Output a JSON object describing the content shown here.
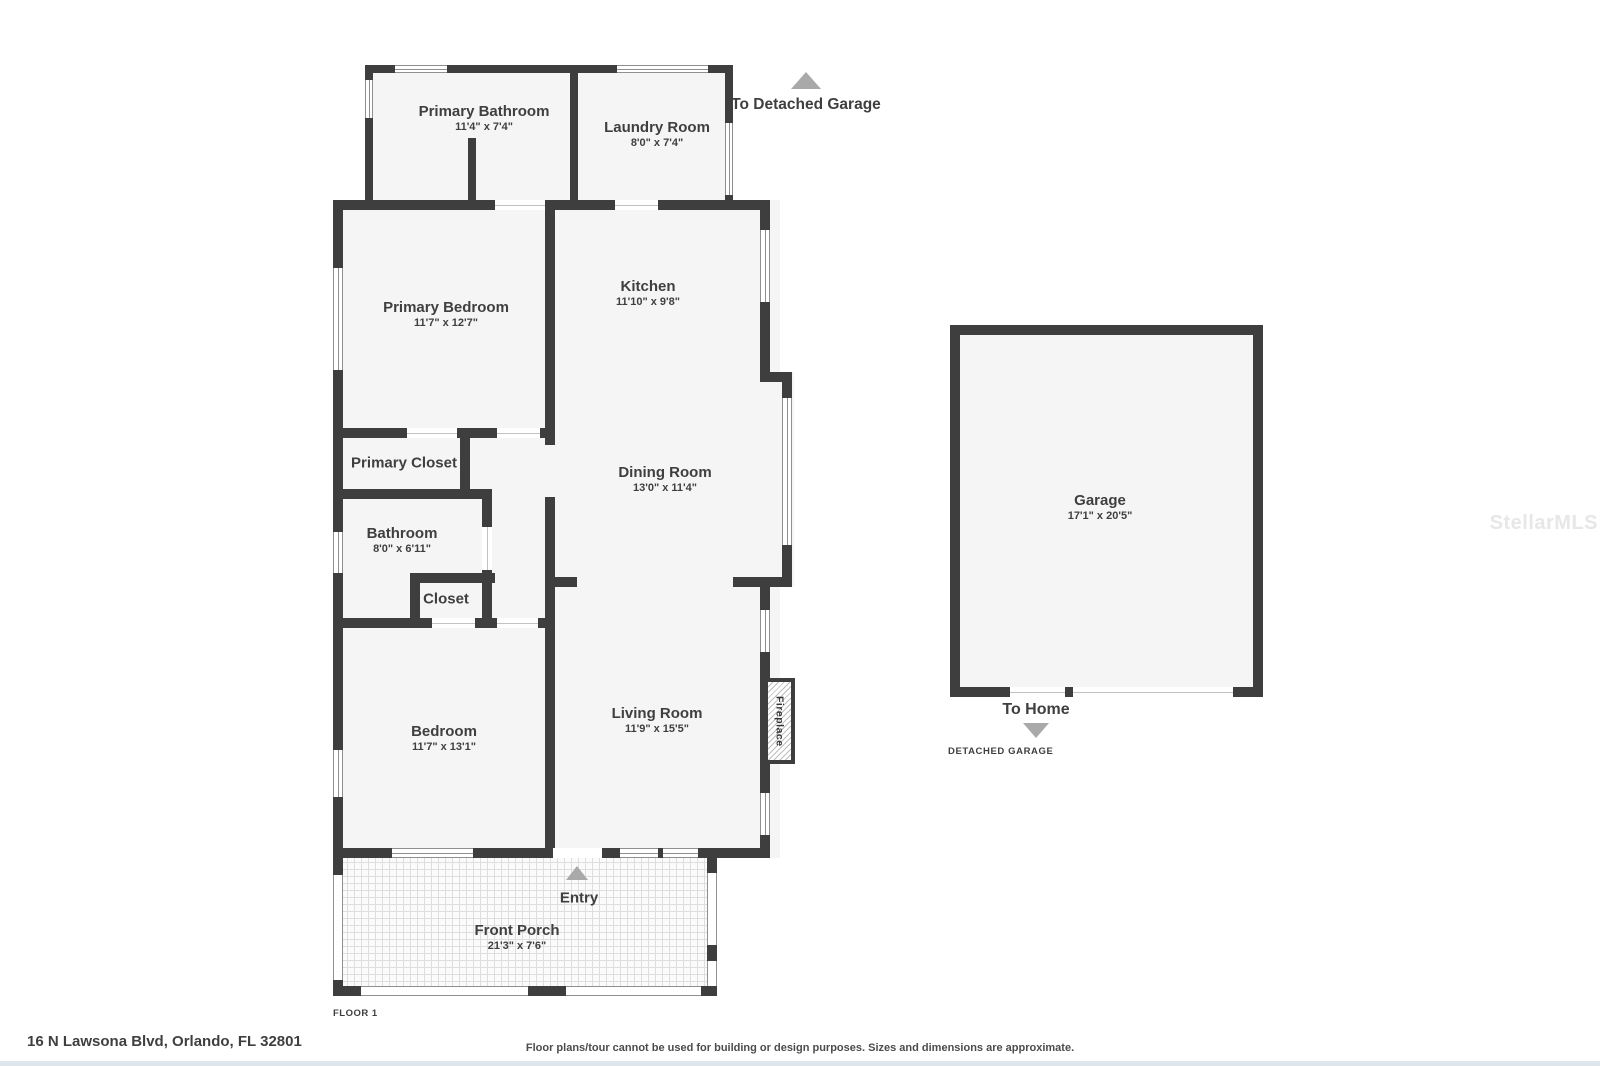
{
  "rooms": [
    {
      "name": "Primary Bathroom",
      "dims": "11'4\" x 7'4\""
    },
    {
      "name": "Laundry Room",
      "dims": "8'0\" x 7'4\""
    },
    {
      "name": "Kitchen",
      "dims": "11'10\" x 9'8\""
    },
    {
      "name": "Primary Bedroom",
      "dims": "11'7\" x 12'7\""
    },
    {
      "name": "Dining Room",
      "dims": "13'0\" x 11'4\""
    },
    {
      "name": "Primary Closet",
      "dims": ""
    },
    {
      "name": "Bathroom",
      "dims": "8'0\" x 6'11\""
    },
    {
      "name": "Closet",
      "dims": ""
    },
    {
      "name": "Bedroom",
      "dims": "11'7\" x 13'1\""
    },
    {
      "name": "Living Room",
      "dims": "11'9\" x 15'5\""
    },
    {
      "name": "Front Porch",
      "dims": "21'3\" x 7'6\""
    },
    {
      "name": "Garage",
      "dims": "17'1\" x 20'5\""
    }
  ],
  "labels": {
    "to_detached_garage": "To Detached Garage",
    "to_home": "To Home",
    "detached_garage": "DETACHED GARAGE",
    "entry": "Entry",
    "fireplace": "Fireplace",
    "floor": "FLOOR 1"
  },
  "footer": {
    "address": "16 N Lawsona Blvd, Orlando, FL 32801",
    "disclaimer": "Floor plans/tour cannot be used for building or design purposes. Sizes and dimensions are approximate."
  },
  "watermark": "StellarMLS",
  "colors": {
    "wall": "#3e3e3e",
    "room_fill": "#f5f5f5",
    "arrow": "#a9a9a9",
    "text": "#3f3f3f",
    "footer_strip": "#dee5eb"
  }
}
